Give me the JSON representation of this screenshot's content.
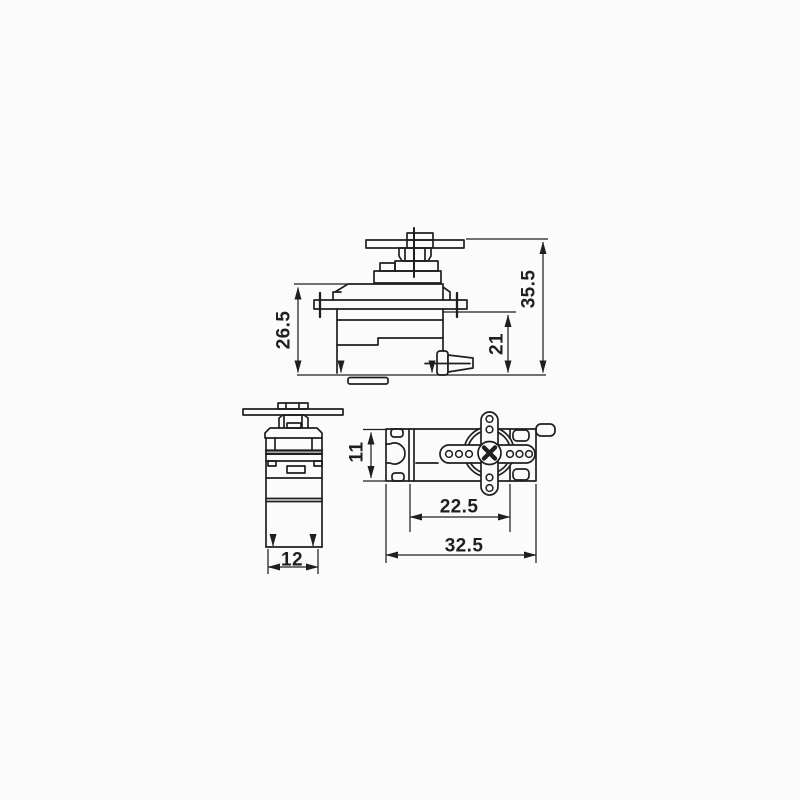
{
  "canvas": {
    "background": "#fbfbfb",
    "line_color": "#1f1f1f"
  },
  "dimensions": {
    "front_view": {
      "body_height": "26.5",
      "flange_to_base": "21",
      "overall_height": "35.5"
    },
    "side_view": {
      "body_width": "12"
    },
    "top_view": {
      "body_depth": "11",
      "body_length": "22.5",
      "mount_length": "32.5"
    }
  }
}
